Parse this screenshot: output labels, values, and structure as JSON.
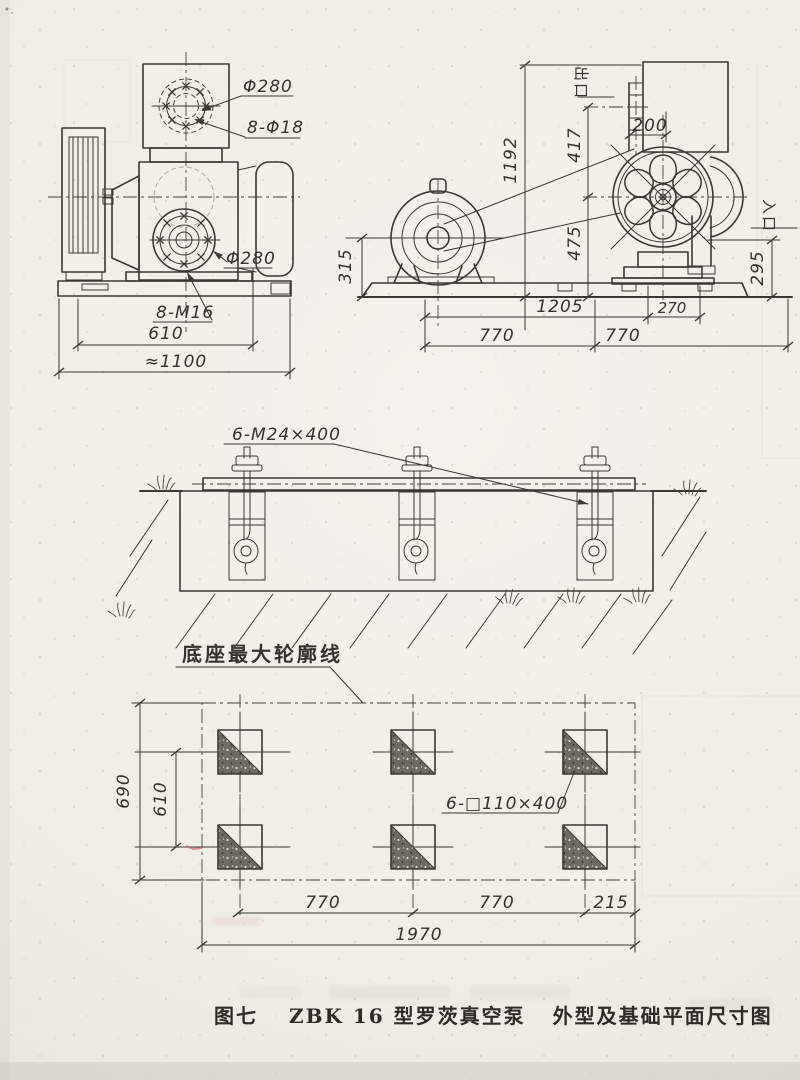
{
  "figure": {
    "caption_figure_no": "图七",
    "caption_model": "ZBK 16 型罗茨真空泵",
    "caption_subtitle": "外型及基础平面尺寸图"
  },
  "side_view": {
    "top_flange_diameter": "Φ280",
    "top_flange_bolt_holes": "8-Φ18",
    "front_flange_diameter": "Φ280",
    "front_flange_bolts": "8-M16",
    "bolt_span": "610",
    "overall_width": "≈1100"
  },
  "front_view": {
    "outlet_label": "出口",
    "inlet_label": "入口",
    "overall_height": "1192",
    "outlet_to_shaft_height": "417",
    "outlet_offset": "200",
    "shaft_to_base_height": "475",
    "motor_shaft_height": "315",
    "inlet_height": "295",
    "base_length": "1205",
    "base_overhang": "270",
    "span_left": "770",
    "span_right": "770"
  },
  "foundation_section": {
    "anchor_bolt_spec": "6-M24×400"
  },
  "plan_view": {
    "outline_label": "底座最大轮廓线",
    "pocket_spec": "6-□110×400",
    "foundation_depth": "690",
    "bolt_row_span": "610",
    "bolt_col_span_1": "770",
    "bolt_col_span_2": "770",
    "edge_margin": "215",
    "overall_length": "1970"
  },
  "colors": {
    "ink": "#3b3833",
    "paper": "#f2f0e9"
  }
}
